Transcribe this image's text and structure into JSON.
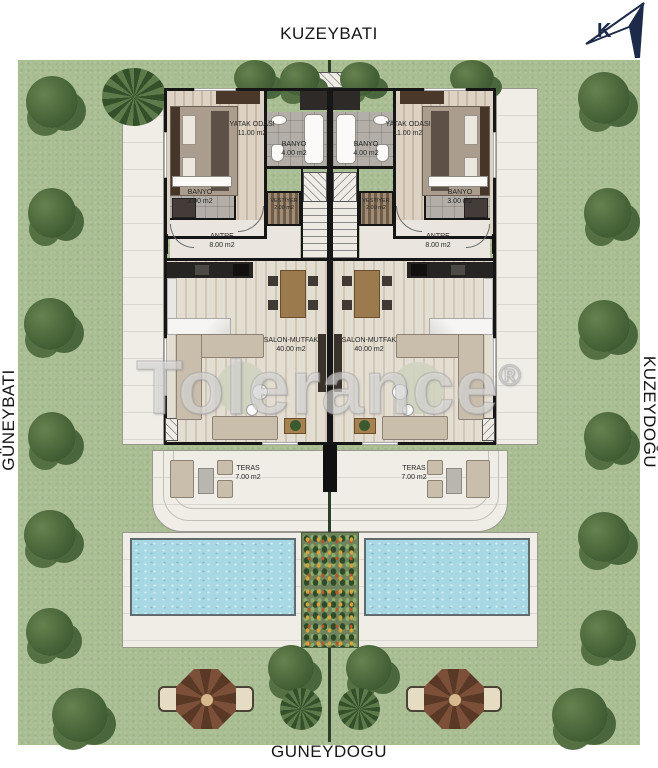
{
  "directions": {
    "top": "KUZEYBATI",
    "bottom": "GÜNEYDOĞU",
    "left": "GÜNEYBATI",
    "right": "KUZEYDOĞU"
  },
  "compass": {
    "letter": "K"
  },
  "watermark": {
    "text": "Tolerance",
    "registered": "®"
  },
  "rooms": {
    "bedroom": {
      "name": "YATAK ODASI",
      "area": "11.00 m2"
    },
    "bath_large": {
      "name": "BANYO",
      "area": "4.00 m2"
    },
    "bath_small": {
      "name": "BANYO",
      "area": "3.00 m2"
    },
    "closet": {
      "name": "VESTİYER",
      "area": "2.00 m2"
    },
    "hall": {
      "name": "ANTRE",
      "area": "8.00 m2"
    },
    "living": {
      "name": "SALON-MUTFAK",
      "area": "40.00 m2"
    },
    "terrace": {
      "name": "TERAS",
      "area": "7.00 m2"
    }
  },
  "colors": {
    "lawn": "#a9bd93",
    "pool_water": "#a7d8e3",
    "paving": "#f0ede7",
    "wall": "#161616",
    "wood_floor": "#d3c5b2",
    "tile_floor": "#b3afa8",
    "gazebo_roof": "#7c4f38",
    "compass_navy": "#1d2a49"
  }
}
